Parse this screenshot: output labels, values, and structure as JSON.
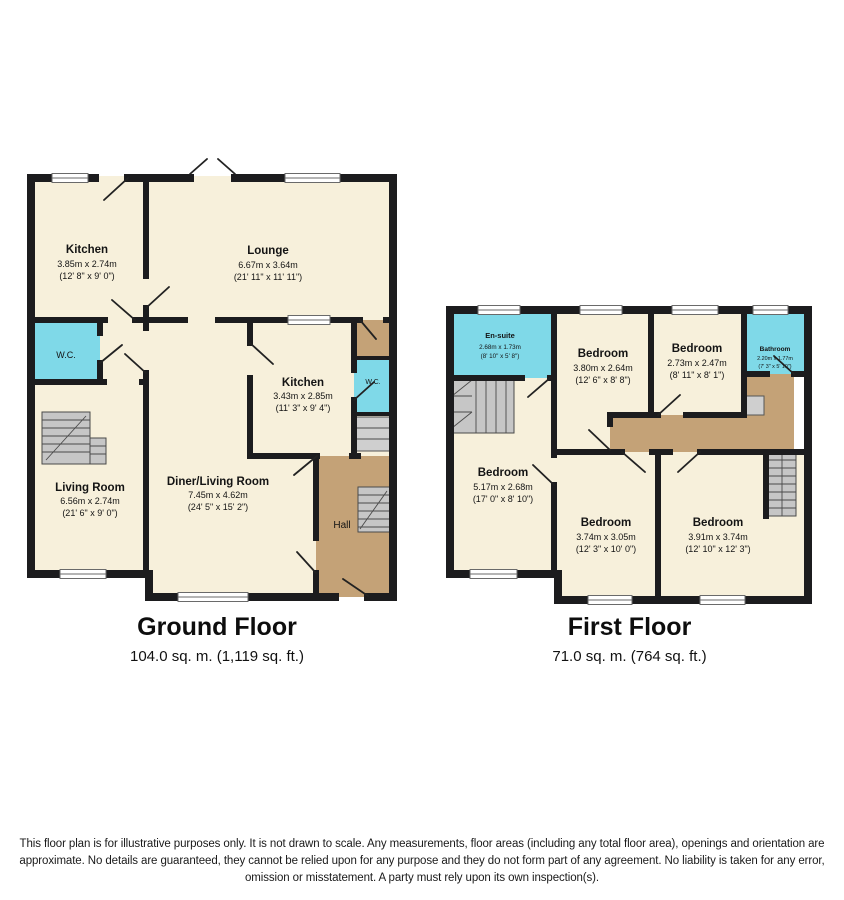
{
  "ground_floor": {
    "title": "Ground Floor",
    "area": "104.0 sq. m. (1,119 sq. ft.)",
    "rooms": {
      "kitchen1": {
        "name": "Kitchen",
        "dims_m": "3.85m x 2.74m",
        "dims_ft": "(12' 8\" x 9' 0\")"
      },
      "lounge": {
        "name": "Lounge",
        "dims_m": "6.67m x 3.64m",
        "dims_ft": "(21' 11\" x 11' 11\")"
      },
      "wc1": {
        "name": "W.C."
      },
      "kitchen2": {
        "name": "Kitchen",
        "dims_m": "3.43m x 2.85m",
        "dims_ft": "(11' 3\" x 9' 4\")"
      },
      "wc2": {
        "name": "W.C."
      },
      "living_room": {
        "name": "Living Room",
        "dims_m": "6.56m x 2.74m",
        "dims_ft": "(21' 6\" x 9' 0\")"
      },
      "diner": {
        "name": "Diner/Living Room",
        "dims_m": "7.45m x 4.62m",
        "dims_ft": "(24' 5\" x 15' 2\")"
      },
      "hall": {
        "name": "Hall"
      }
    }
  },
  "first_floor": {
    "title": "First Floor",
    "area": "71.0 sq. m. (764 sq. ft.)",
    "rooms": {
      "ensuite": {
        "name": "En-suite",
        "dims_m": "2.68m x 1.73m",
        "dims_ft": "(8' 10\" x 5' 8\")"
      },
      "bedroom1": {
        "name": "Bedroom",
        "dims_m": "3.80m x 2.64m",
        "dims_ft": "(12' 6\" x 8' 8\")"
      },
      "bedroom2": {
        "name": "Bedroom",
        "dims_m": "2.73m x 2.47m",
        "dims_ft": "(8' 11\" x 8' 1\")"
      },
      "bathroom": {
        "name": "Bathroom",
        "dims_m": "2.20m x 1.77m",
        "dims_ft": "(7' 3\" x 5' 10\")"
      },
      "bedroom3": {
        "name": "Bedroom",
        "dims_m": "5.17m x 2.68m",
        "dims_ft": "(17' 0\" x 8' 10\")"
      },
      "bedroom4": {
        "name": "Bedroom",
        "dims_m": "3.74m x 3.05m",
        "dims_ft": "(12' 3\" x 10' 0\")"
      },
      "bedroom5": {
        "name": "Bedroom",
        "dims_m": "3.91m x 3.74m",
        "dims_ft": "(12' 10\" x 12' 3\")"
      }
    }
  },
  "disclaimer": {
    "line1": "This floor plan is for illustrative purposes only. It is not drawn to scale. Any measurements, floor areas (including any total floor area), openings and orientation are",
    "line2": "approximate. No details are guaranteed, they cannot be relied upon for any purpose and they do not form part of any agreement. No liability is taken for any error,",
    "line3": "omission or misstatement. A party must rely upon its own inspection(s)."
  },
  "colors": {
    "room_cream": "#F7F0DB",
    "wet_room_cyan": "#7FD9E8",
    "circulation_brown": "#C4A277",
    "wall_black": "#1C1C1E",
    "stairs_gray": "#C6C6C6"
  }
}
